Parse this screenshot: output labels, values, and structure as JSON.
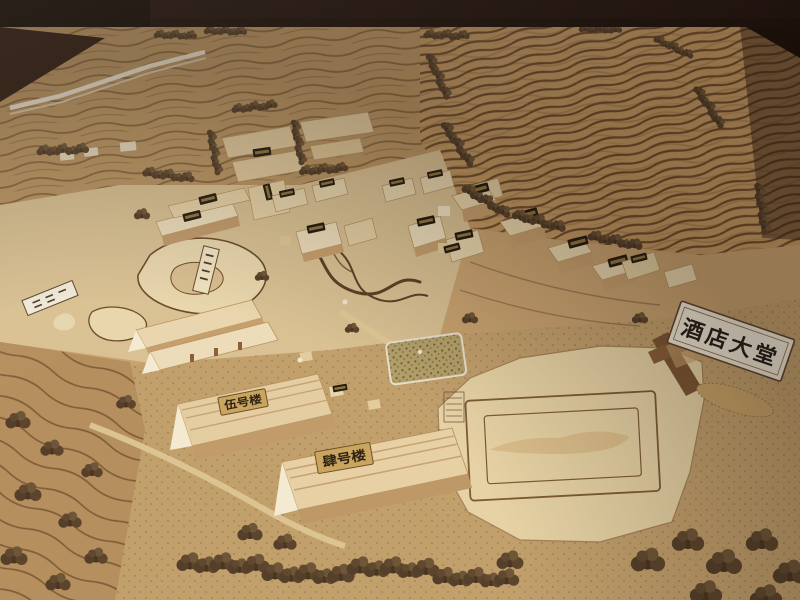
{
  "signs": {
    "hotel_lobby": {
      "label": "酒店大堂"
    },
    "building_no5": {
      "label": "伍号楼"
    },
    "building_no4": {
      "label": "肆号楼"
    }
  },
  "colors": {
    "background_dark": "#221410",
    "table_wood": "#2e1b10",
    "terrain_base": "#c9a370",
    "terrain_hill": "#c49a63",
    "contour_line": "#6f4e2c",
    "flat_cream": "#d9c193",
    "lake_fill": "#e8d6ac",
    "plaza_plywood": "#e6d2a4",
    "building_roof": "#e8d5ac",
    "building_side": "#c69f6e",
    "tree_foam_dark": "#4a3522",
    "tree_foam_light": "#6e5738",
    "sign_board": "#f0e8d6",
    "sign_text": "#262019",
    "brass_placard": "#c9a55f",
    "placard_dark": "#241c12",
    "placard_gold": "#b5914e",
    "gate_wood": "#8a6038"
  }
}
